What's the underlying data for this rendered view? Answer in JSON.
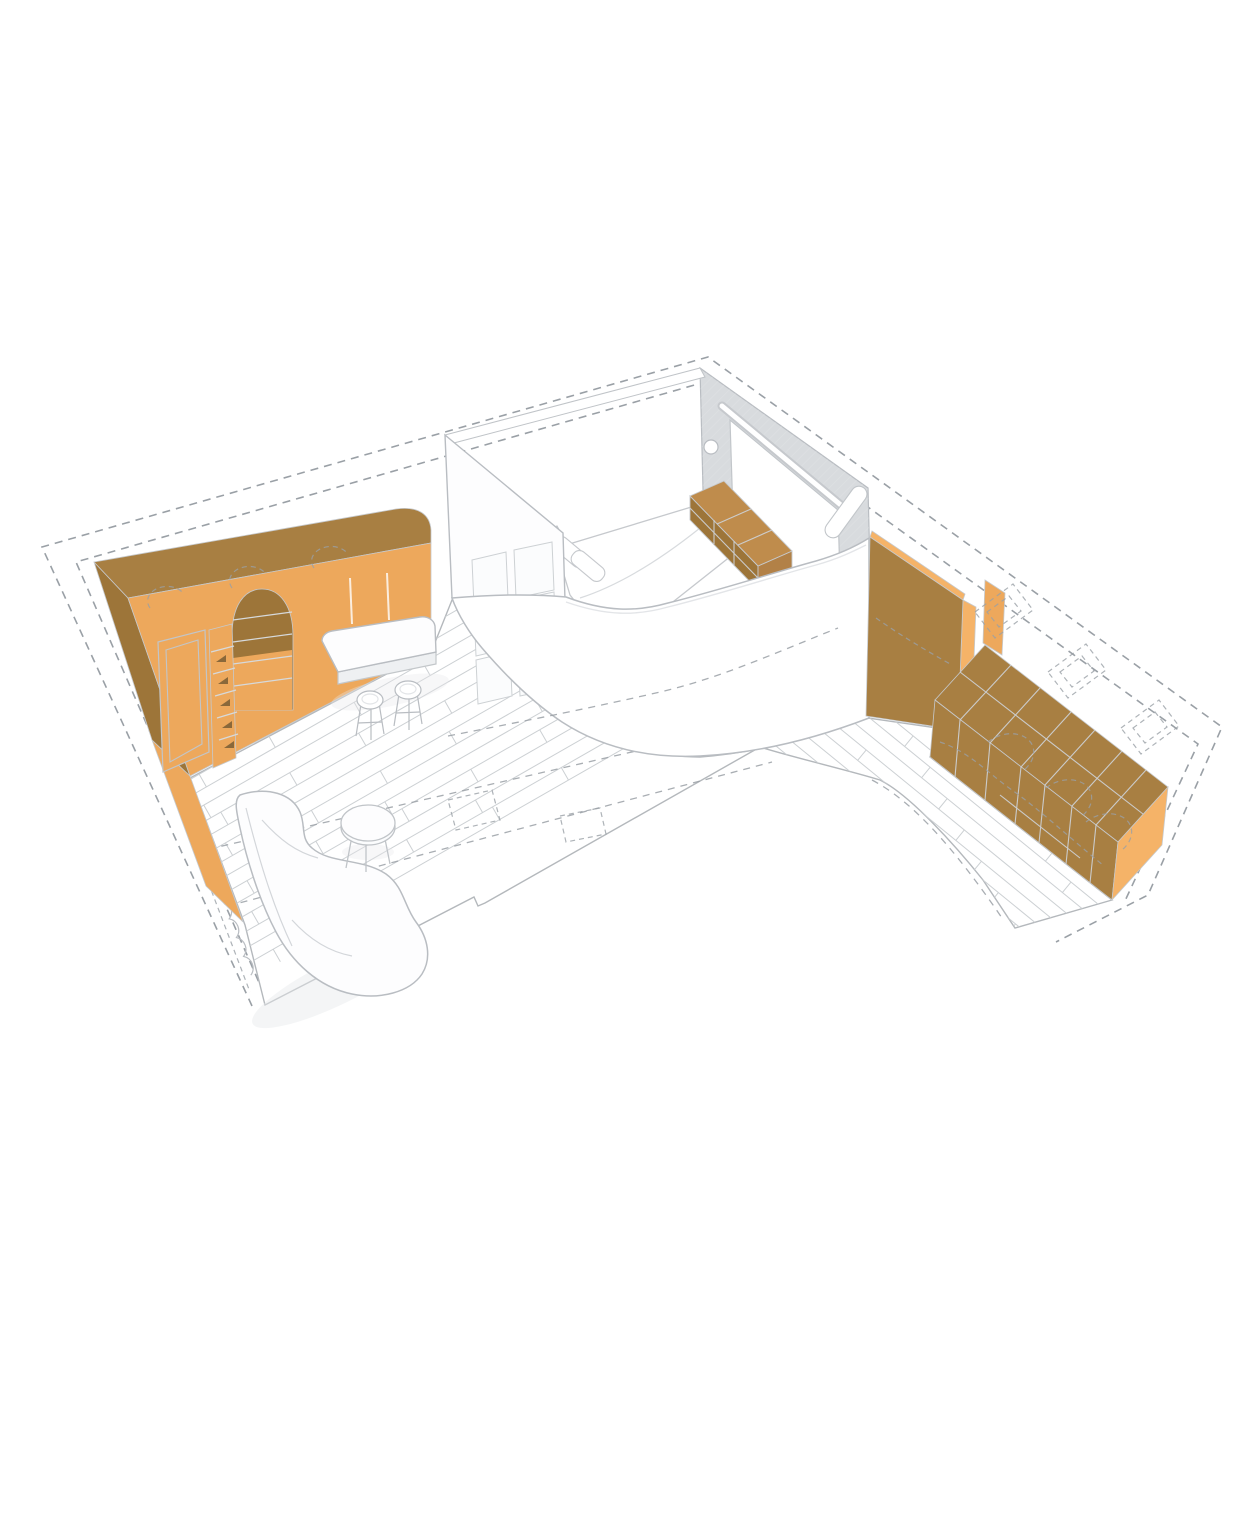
{
  "page": {
    "title": "Axonometric cutaway illustration of an L-shaped apartment with orange joinery",
    "background": "#ffffff"
  },
  "colors": {
    "orange_light": "#eda85c",
    "orange_lighter": "#f5b368",
    "orange_dark": "#a87f42",
    "orange_deep": "#9d7539",
    "dresser_top": "#bf8c4c",
    "dresser_end": "#b28147",
    "niche_shadow": "#8a683a",
    "line": "#b9bdc2",
    "line_soft": "#d3d6da",
    "plank": "#ccd0d3",
    "dash": "#9aa0a6",
    "wall_gray": "#d8dbde",
    "white": "#ffffff",
    "shade": "#eef0f2",
    "shadow": "#e7e9eb"
  },
  "scene": {
    "type": "axonometric-floor-plan",
    "rooms": [
      {
        "name": "living-dining-area"
      },
      {
        "name": "bedroom-pod"
      },
      {
        "name": "kitchen-corridor"
      }
    ],
    "elements": [
      {
        "name": "dashed-envelope-outline"
      },
      {
        "name": "plank-flooring"
      },
      {
        "name": "orange-storage-wall-with-arched-niche"
      },
      {
        "name": "kitchen-island-with-two-stools"
      },
      {
        "name": "round-side-table"
      },
      {
        "name": "curved-lounge-chair"
      },
      {
        "name": "curtain-line"
      },
      {
        "name": "bedroom-back-wall-with-sliding-door"
      },
      {
        "name": "bed-with-pillows-and-duvet"
      },
      {
        "name": "foot-of-bed-dresser"
      },
      {
        "name": "wardrobe-door-wall"
      },
      {
        "name": "curved-bedroom-wall"
      },
      {
        "name": "orange-partition-panel"
      },
      {
        "name": "orange-kitchen-cabinet-run"
      },
      {
        "name": "dashed-appliance-outlines"
      }
    ]
  }
}
